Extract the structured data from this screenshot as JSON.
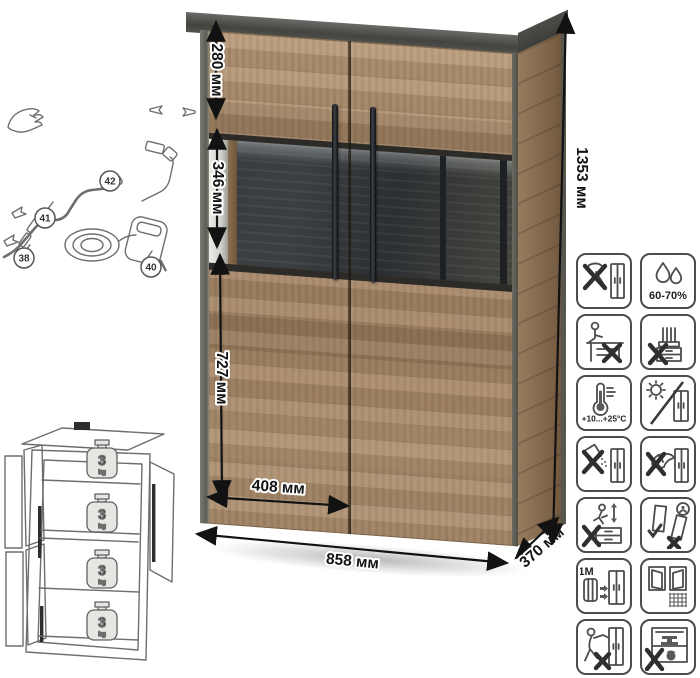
{
  "dims": {
    "h_total": "1353 мм",
    "h_top": "280 мм",
    "h_glass": "346 мм",
    "h_lower": "727 мм",
    "w_door": "408 мм",
    "w_total": "858 мм",
    "depth": "370 мм"
  },
  "cable": {
    "c38": "38",
    "c40": "40",
    "c41": "41",
    "c42": "42"
  },
  "shelf_load": {
    "value": "3",
    "unit": "kg"
  },
  "care": {
    "humidity": "60-70%",
    "temperature": "+10...+25°C",
    "distance": "≥1M"
  },
  "colors": {
    "wood": "#a98b69",
    "dark_panel": "#3b3f42",
    "icon_stroke": "#4c4c4c",
    "dimension_text": "#141414",
    "background": "#ffffff"
  }
}
